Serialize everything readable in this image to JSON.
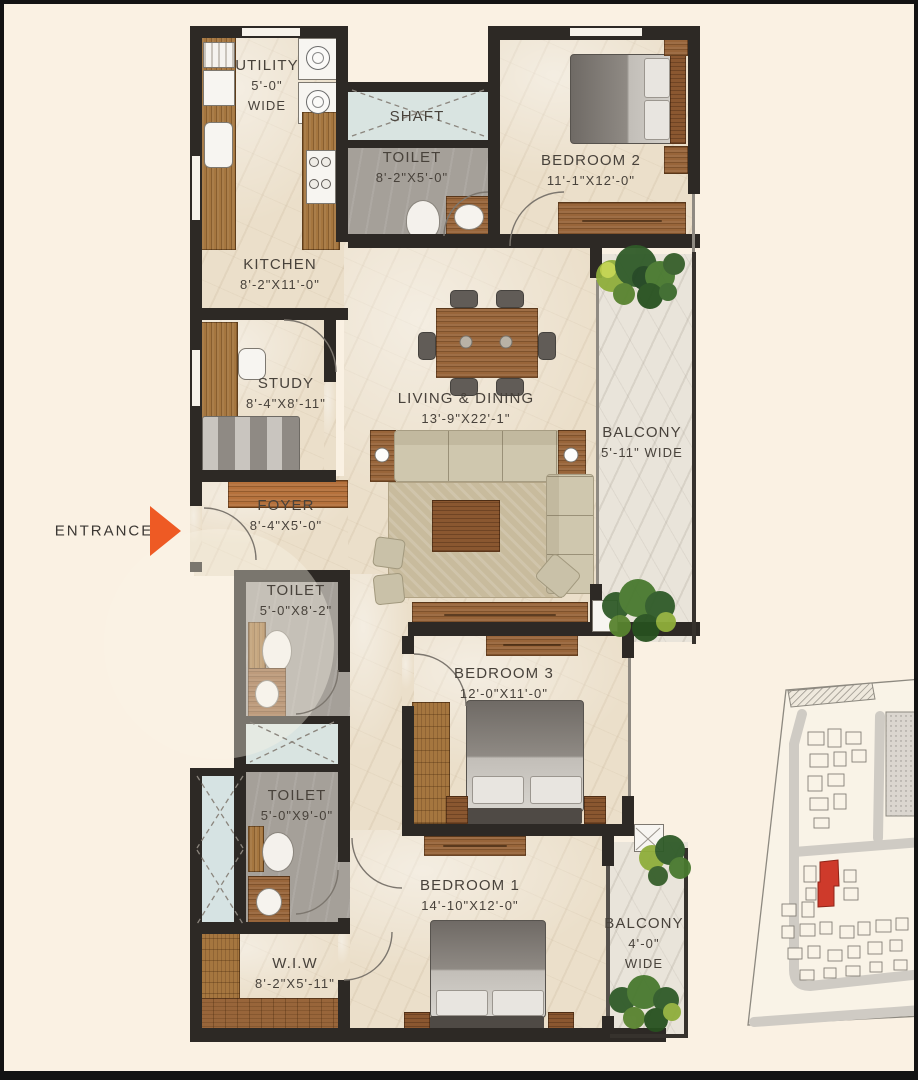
{
  "entrance": {
    "label": "ENTRANCE"
  },
  "rooms": {
    "utility": {
      "name": "UTILITY",
      "dim": "5'-0\"",
      "wide": "WIDE"
    },
    "shaft": {
      "name": "SHAFT"
    },
    "toilet_top": {
      "name": "TOILET",
      "dims": "8'-2\"X5'-0\""
    },
    "bedroom2": {
      "name": "BEDROOM 2",
      "dims": "11'-1\"X12'-0\""
    },
    "kitchen": {
      "name": "KITCHEN",
      "dims": "8'-2\"X11'-0\""
    },
    "study": {
      "name": "STUDY",
      "dims": "8'-4\"X8'-11\""
    },
    "living_dining": {
      "name": "LIVING & DINING",
      "dims": "13'-9\"X22'-1\""
    },
    "balcony_right": {
      "name": "BALCONY",
      "dims": "5'-11\" WIDE"
    },
    "foyer": {
      "name": "FOYER",
      "dims": "8'-4\"X5'-0\""
    },
    "toilet_mid": {
      "name": "TOILET",
      "dims": "5'-0\"X8'-2\""
    },
    "bedroom3": {
      "name": "BEDROOM 3",
      "dims": "12'-0\"X11'-0\""
    },
    "toilet_low": {
      "name": "TOILET",
      "dims": "5'-0\"X9'-0\""
    },
    "bedroom1": {
      "name": "BEDROOM 1",
      "dims": "14'-10\"X12'-0\""
    },
    "wiw": {
      "name": "W.I.W",
      "dim": "8'-2\"X5'-11\""
    },
    "balcony_bottom": {
      "name": "BALCONY",
      "dim": "4'-0\"",
      "wide": "WIDE"
    }
  },
  "colors": {
    "entrance_arrow": "#ee5a24",
    "site_highlight": "#ce3a2b",
    "wall": "#2d2925",
    "wood": "#98653a",
    "floor": "#ebdfca"
  }
}
